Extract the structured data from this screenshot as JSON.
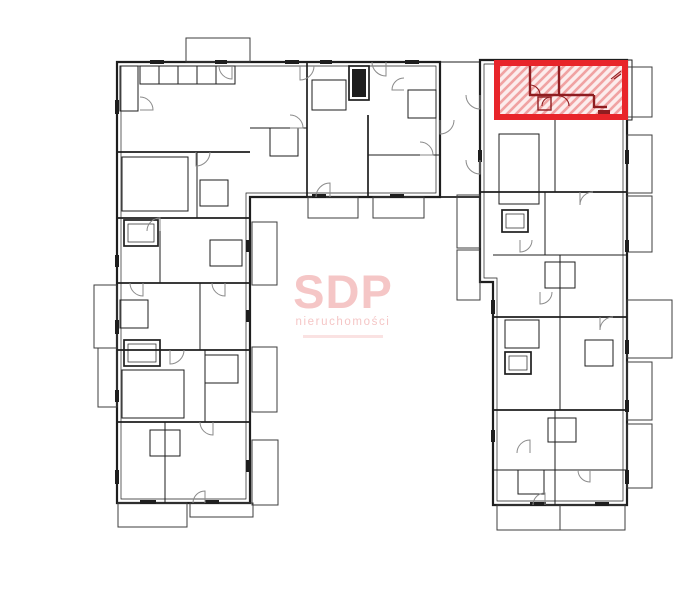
{
  "watermark": {
    "brand": "SDP",
    "subtitle": "nieruchomości"
  },
  "colors": {
    "background": "#ffffff",
    "line": "#1e1e1e",
    "partition": "#3d3d3d",
    "arc": "#8a8a8a",
    "hl_border": "#e8252a",
    "hl_fill": "#fcecec",
    "hl_hatch": "#f0a2a2",
    "hl_wall": "#8f1d20",
    "watermark_pink": "#f5c6c6"
  }
}
